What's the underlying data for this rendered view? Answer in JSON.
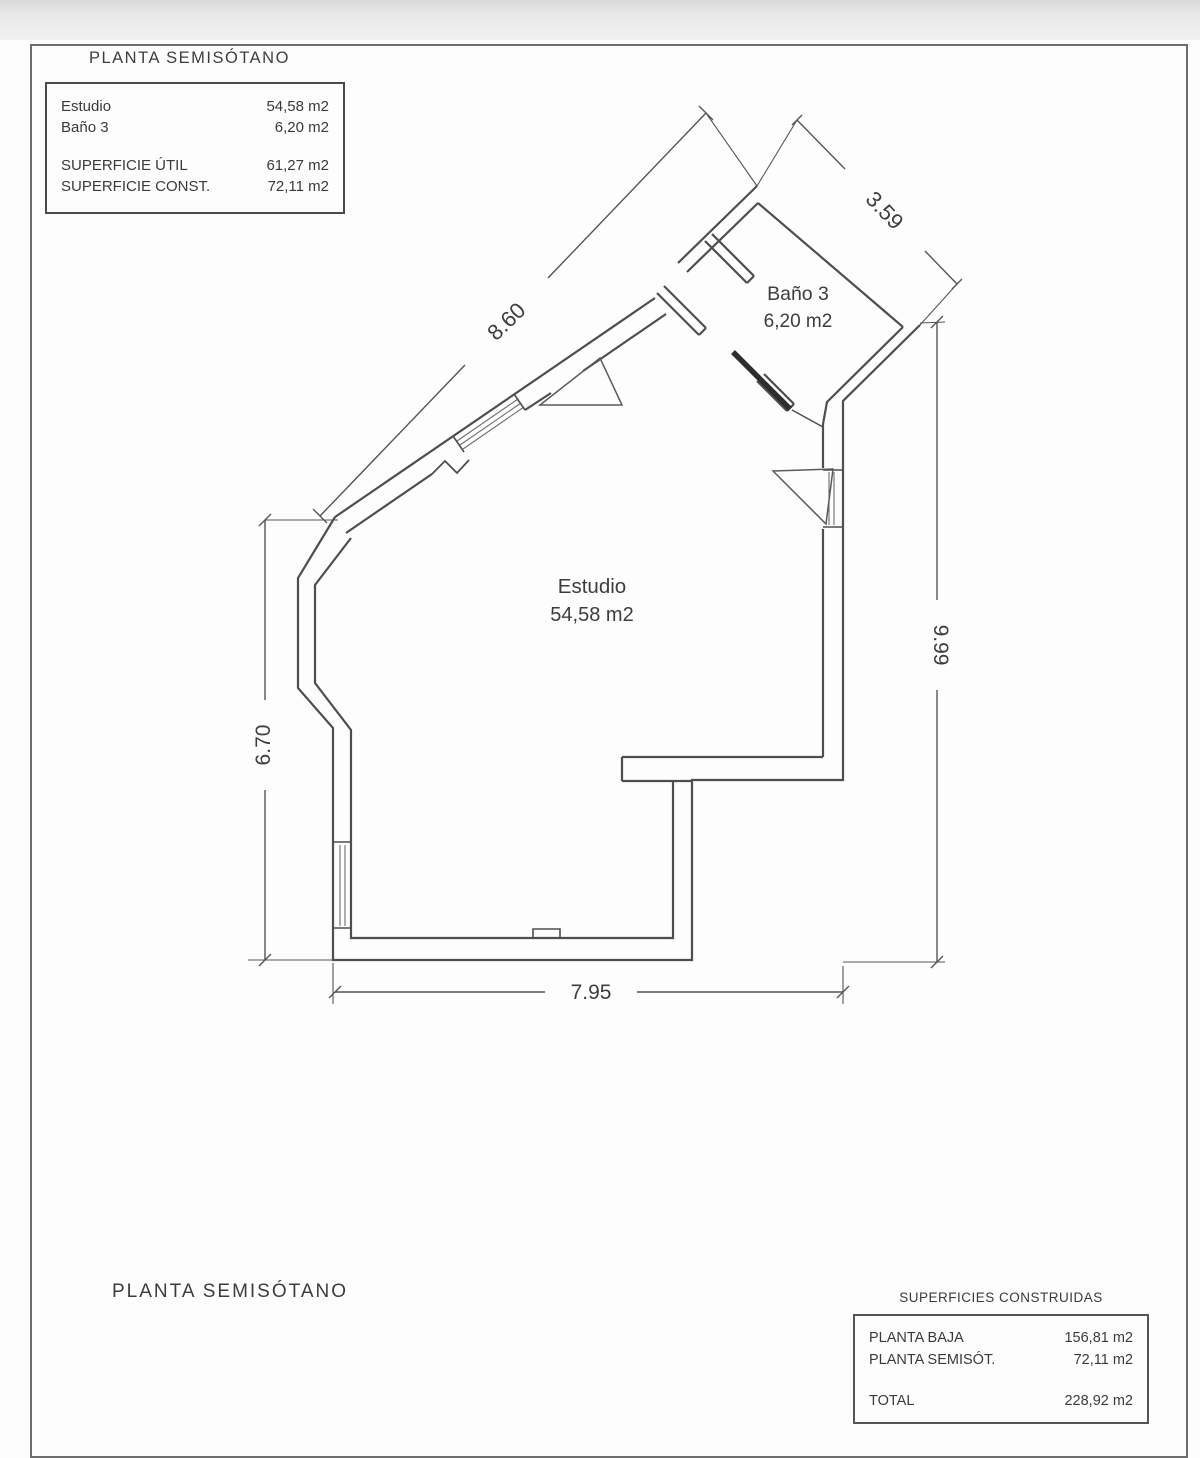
{
  "page": {
    "title_top": "PLANTA SEMISÓTANO",
    "footer_label": "PLANTA SEMISÓTANO"
  },
  "legend": {
    "rooms": [
      {
        "label": "Estudio",
        "value": "54,58 m2"
      },
      {
        "label": "Baño 3",
        "value": "6,20 m2"
      }
    ],
    "totals": [
      {
        "label": "SUPERFICIE ÚTIL",
        "value": "61,27 m2"
      },
      {
        "label": "SUPERFICIE CONST.",
        "value": "72,11 m2"
      }
    ]
  },
  "plan": {
    "rooms": [
      {
        "name": "Estudio",
        "area": "54,58 m2"
      },
      {
        "name": "Baño 3",
        "area": "6,20 m2"
      }
    ],
    "dimensions": {
      "top_left": "8.60",
      "top_right": "3.59",
      "right": "9.99",
      "left": "6.70",
      "bottom": "7.95"
    },
    "wall_color": "#4e4e4e",
    "dim_color": "#555555"
  },
  "summary": {
    "title": "SUPERFICIES CONSTRUIDAS",
    "rows": [
      {
        "label": "PLANTA BAJA",
        "value": "156,81 m2"
      },
      {
        "label": "PLANTA SEMISÓT.",
        "value": "72,11 m2"
      }
    ],
    "total": {
      "label": "TOTAL",
      "value": "228,92 m2"
    }
  }
}
